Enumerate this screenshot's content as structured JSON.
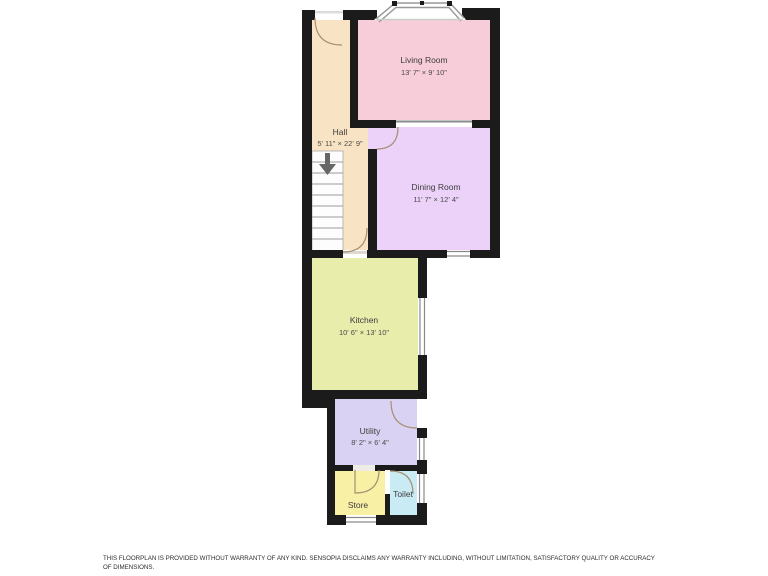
{
  "floorplan": {
    "wall_color": "#1b1b1b",
    "rooms": [
      {
        "id": "living-room",
        "name": "Living Room",
        "dimensions": "13' 7\" × 9' 10\"",
        "color": "#f6cdd8"
      },
      {
        "id": "hall",
        "name": "Hall",
        "dimensions": "5' 11\" × 22' 9\"",
        "color": "#f9e3c5"
      },
      {
        "id": "dining-room",
        "name": "Dining Room",
        "dimensions": "11' 7\" × 12' 4\"",
        "color": "#ecd2f8"
      },
      {
        "id": "kitchen",
        "name": "Kitchen",
        "dimensions": "10' 6\" × 13' 10\"",
        "color": "#e9edab"
      },
      {
        "id": "utility",
        "name": "Utility",
        "dimensions": "8' 2\" × 6' 4\"",
        "color": "#d9d2f2"
      },
      {
        "id": "store",
        "name": "Store",
        "dimensions": "",
        "color": "#f8f0a5"
      },
      {
        "id": "toilet",
        "name": "Toilet",
        "dimensions": "",
        "color": "#c9ebf4"
      }
    ],
    "icons": {
      "stairs_arrow": "down-arrow"
    }
  },
  "disclaimer": "THIS FLOORPLAN IS PROVIDED WITHOUT WARRANTY OF ANY KIND. SENSOPIA DISCLAIMS ANY WARRANTY INCLUDING, WITHOUT LIMITATION, SATISFACTORY QUALITY OR ACCURACY OF DIMENSIONS."
}
